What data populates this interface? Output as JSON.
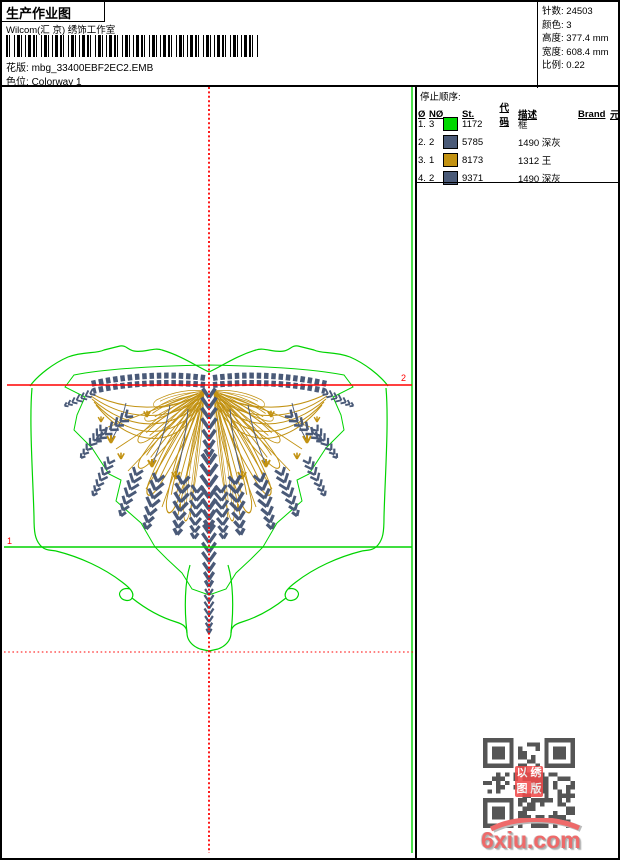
{
  "header": {
    "title": "生产作业图",
    "studio": "Wilcom(汇 京) 绣饰工作室",
    "pattern_label": "花版:",
    "pattern_value": "mbg_33400EBF2EC2.EMB",
    "colorway_label": "色位:",
    "colorway_value": "Colorway 1"
  },
  "info": {
    "stitches_label": "针数:",
    "stitches_value": "24503",
    "colors_label": "颜色:",
    "colors_value": "3",
    "height_label": "高度:",
    "height_value": "377.4 mm",
    "width_label": "宽度:",
    "width_value": "608.4 mm",
    "ratio_label": "比例:",
    "ratio_value": "0.22"
  },
  "stop_sequence": {
    "title": "停止顺序:",
    "columns": {
      "hash": "Ø",
      "needle": "NØ",
      "st": "St.",
      "code": "代码",
      "desc": "描述",
      "brand": "Brand",
      "element": "元素"
    },
    "rows": [
      {
        "seq": "1.",
        "needle": "3",
        "color": "#00d800",
        "st": "1172",
        "code": "5",
        "desc": "框"
      },
      {
        "seq": "2.",
        "needle": "2",
        "color": "#4a5a78",
        "st": "5785",
        "code": "",
        "desc": "1490 深灰"
      },
      {
        "seq": "3.",
        "needle": "1",
        "color": "#c29212",
        "st": "8173",
        "code": "",
        "desc": "1312 王"
      },
      {
        "seq": "4.",
        "needle": "2",
        "color": "#4a5a78",
        "st": "9371",
        "code": "",
        "desc": "1490 深灰"
      }
    ]
  },
  "markers": {
    "left": "1",
    "right": "2"
  },
  "design_colors": {
    "outline_green": "#00d400",
    "thread_dark": "#4a5a78",
    "thread_gold": "#c29212",
    "axis_red": "#ff0000",
    "qr_gray": "#555555"
  },
  "stamp": {
    "tl": "以",
    "tr": "绣",
    "bl": "图",
    "br": "版"
  },
  "watermark": {
    "text": "6xiu.com"
  }
}
